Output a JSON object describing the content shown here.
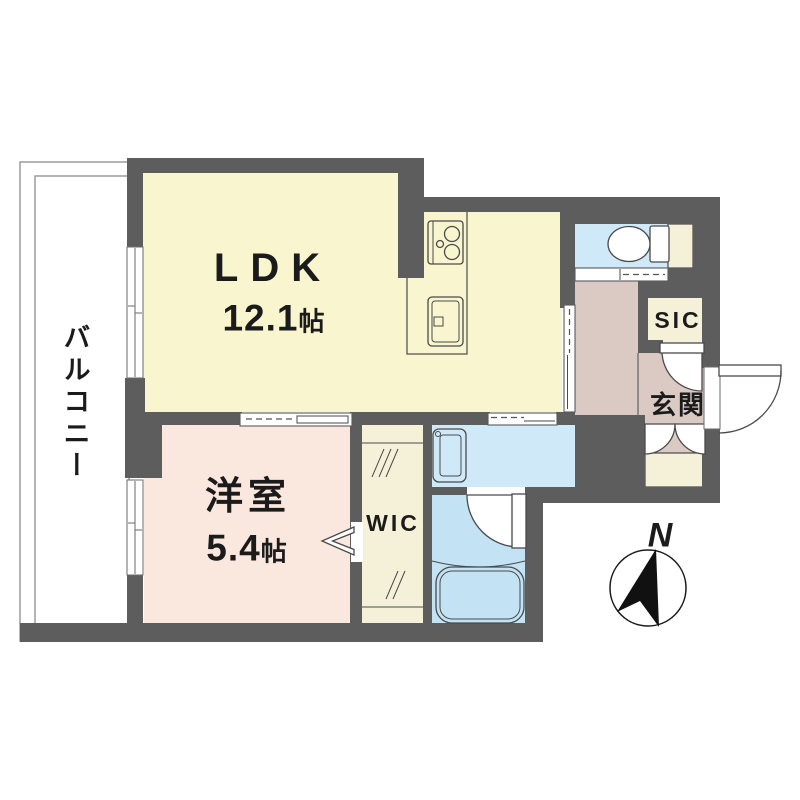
{
  "plan": {
    "rooms": {
      "ldk": {
        "label": "LDK",
        "size_value": "12.1",
        "size_unit": "帖"
      },
      "bedroom": {
        "label": "洋室",
        "size_value": "5.4",
        "size_unit": "帖"
      },
      "wic": {
        "label": "WIC"
      },
      "sic": {
        "label": "SIC"
      },
      "entrance": {
        "label": "玄関"
      },
      "balcony": {
        "label": "バルコニー"
      }
    },
    "compass": {
      "north_label": "N"
    },
    "fixtures": [
      "gas-stove-icon",
      "kitchen-sink-icon",
      "toilet-icon",
      "washbasin-icon",
      "bathtub-icon",
      "north-arrow-icon"
    ],
    "colors": {
      "wall": "#5e5d5d",
      "ldk_floor": "#f8f5cf",
      "bedroom_floor": "#fae8de",
      "closet_floor": "#f5f1d9",
      "toilet_washroom_floor": "#cfe9f8",
      "bathroom_floor": "#c3e3f4",
      "hall_entrance_floor": "#dbcac4",
      "text": "#1b1b1b"
    }
  }
}
